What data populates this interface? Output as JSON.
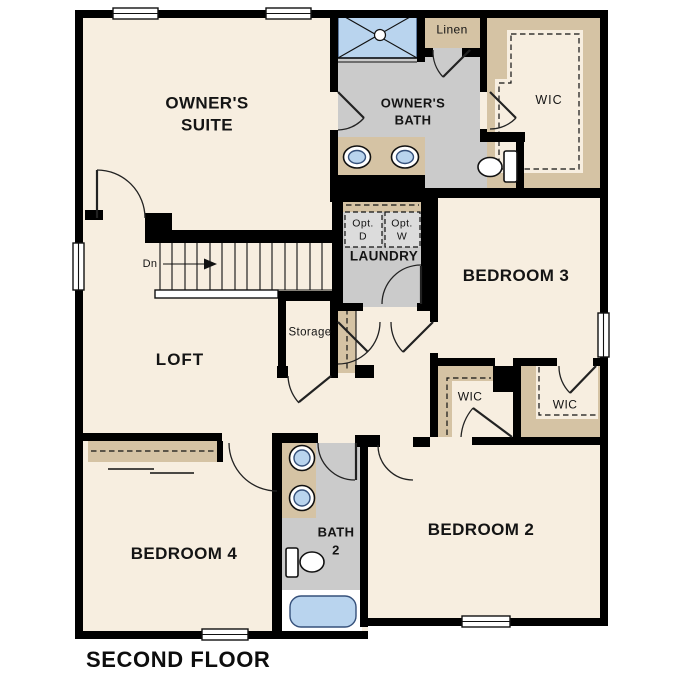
{
  "title": "SECOND FLOOR",
  "rooms": {
    "owners_suite": "OWNER'S\nSUITE",
    "owners_bath": "OWNER'S\nBATH",
    "loft": "LOFT",
    "laundry": "LAUNDRY",
    "bedroom_2": "BEDROOM 2",
    "bedroom_3": "BEDROOM 3",
    "bedroom_4": "BEDROOM 4",
    "bath_2": "BATH\n2",
    "storage": "Storage",
    "linen": "Linen",
    "wic_owner": "WIC",
    "wic_bedroom2": "WIC",
    "wic_bedroom3": "WIC",
    "opt_dryer": "Opt.\nD",
    "opt_washer": "Opt.\nW",
    "stairs_down": "Dn"
  },
  "colors": {
    "wall": "#000000",
    "floor": "#f7eee0",
    "wet": "#cbcbcb",
    "counter": "#d5c3a4",
    "blue": "#b9d4ee",
    "optbox": "#dcdcdc"
  }
}
